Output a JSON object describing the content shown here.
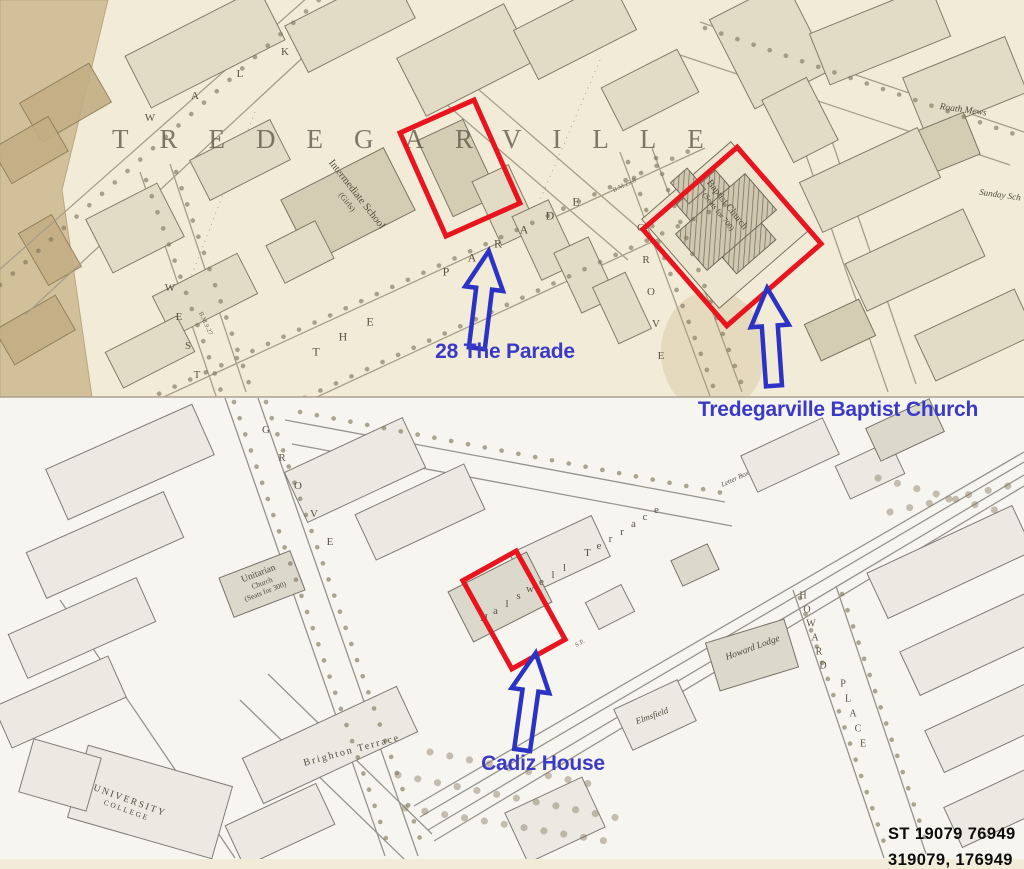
{
  "map": {
    "district_label": "TREDEGARVILLE",
    "street_labels": [
      {
        "id": "walk",
        "text": "WALK"
      },
      {
        "id": "the",
        "text": "THE"
      },
      {
        "id": "parade",
        "text": "PARADE"
      },
      {
        "id": "west",
        "text": "WEST"
      },
      {
        "id": "grove_west",
        "text": "GROVE"
      },
      {
        "id": "grove_east",
        "text": "GROVE"
      },
      {
        "id": "howard",
        "text": "HOWARD"
      },
      {
        "id": "place",
        "text": "PLACE"
      },
      {
        "id": "halswell",
        "text": "Halswell Terrace"
      }
    ],
    "building_labels": [
      {
        "id": "intermediate_school",
        "lines": [
          "Intermediate School",
          "(Girls)"
        ]
      },
      {
        "id": "baptist_church",
        "lines": [
          "Baptist Church",
          "(Seats for 700)"
        ]
      },
      {
        "id": "unitarian_church",
        "lines": [
          "Unitarian",
          "Church",
          "(Seats for 300)"
        ]
      },
      {
        "id": "university_college",
        "lines": [
          "UNIVERSITY",
          "COLLEGE"
        ]
      },
      {
        "id": "howard_lodge",
        "lines": [
          "Howard Lodge"
        ]
      },
      {
        "id": "brighton_terrace",
        "lines": [
          "Brighton Terrace"
        ]
      },
      {
        "id": "roath_mews",
        "lines": [
          "Roath Mews"
        ]
      },
      {
        "id": "sunday_school",
        "lines": [
          "Sunday Sch"
        ]
      },
      {
        "id": "elmsfield",
        "lines": [
          "Elmsfield"
        ]
      },
      {
        "id": "letter_box",
        "lines": [
          "Letter Box"
        ]
      }
    ],
    "tiny_marks": [
      {
        "id": "bm1",
        "text": "B.M.9.27"
      },
      {
        "id": "bm2",
        "text": "B.M.25.8"
      },
      {
        "id": "sp",
        "text": "S.P."
      }
    ]
  },
  "annotations": {
    "highlight_color": "#e8141e",
    "label_color": "#3a3ac6",
    "items": [
      {
        "id": "parade28",
        "label": "28 The Parade"
      },
      {
        "id": "baptist",
        "label": "Tredegarville Baptist Church"
      },
      {
        "id": "cadiz",
        "label": "Cadiz House"
      }
    ]
  },
  "grid_reference": {
    "primary": "ST 19079 76949",
    "secondary": "319079, 176949"
  }
}
